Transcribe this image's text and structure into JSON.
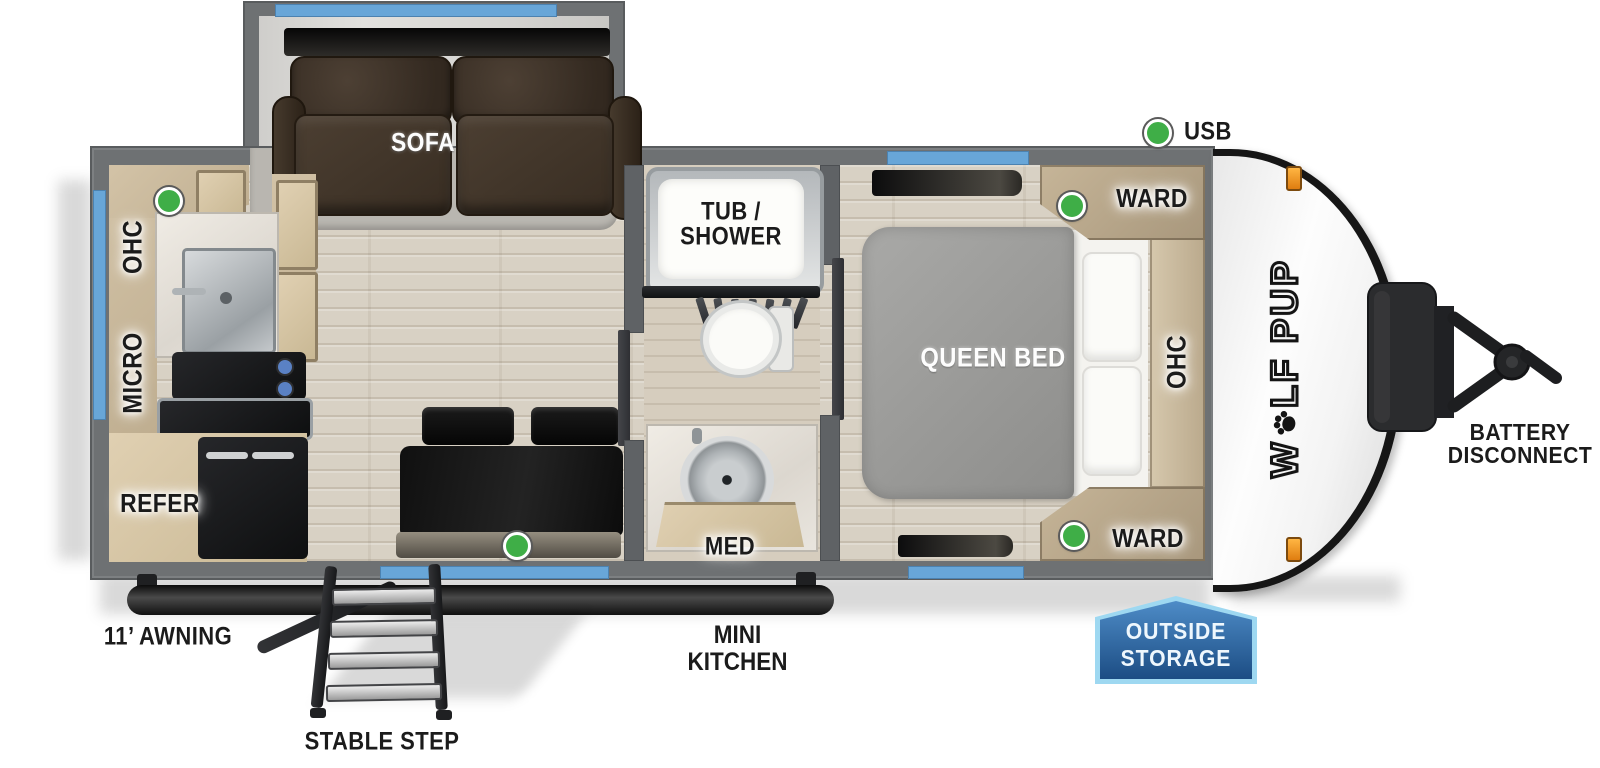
{
  "legend": {
    "usb": "USB"
  },
  "slide": {
    "sofa": "SOFA"
  },
  "kitchen": {
    "ohc": "OHC",
    "micro": "MICRO",
    "refer": "REFER"
  },
  "bath": {
    "tub_line1": "TUB /",
    "tub_line2": "SHOWER",
    "med": "MED"
  },
  "bedroom": {
    "queen_bed": "QUEEN BED",
    "ward_front": "WARD",
    "ward_rear": "WARD",
    "ohc": "OHC"
  },
  "cap": {
    "logo_w": "W",
    "logo_rest": "LF PUP"
  },
  "exterior": {
    "battery_line1": "BATTERY",
    "battery_line2": "DISCONNECT",
    "awning": "11’ AWNING",
    "stable_step": "STABLE STEP",
    "mini_kitchen_line1": "MINI",
    "mini_kitchen_line2": "KITCHEN",
    "outside_storage_line1": "OUTSIDE",
    "outside_storage_line2": "STORAGE"
  },
  "colors": {
    "wall": "#6e7173",
    "window_blue": "#68a6d8",
    "usb_green": "#3fae47",
    "badge_blue": "#2a6cab",
    "badge_border": "#9ed8f1",
    "clearance_light": "#f0991f",
    "floor_wood": "#d8d1c4",
    "sofa_brown": "#463a2e",
    "cabinet_wood": "#c7b69c"
  }
}
